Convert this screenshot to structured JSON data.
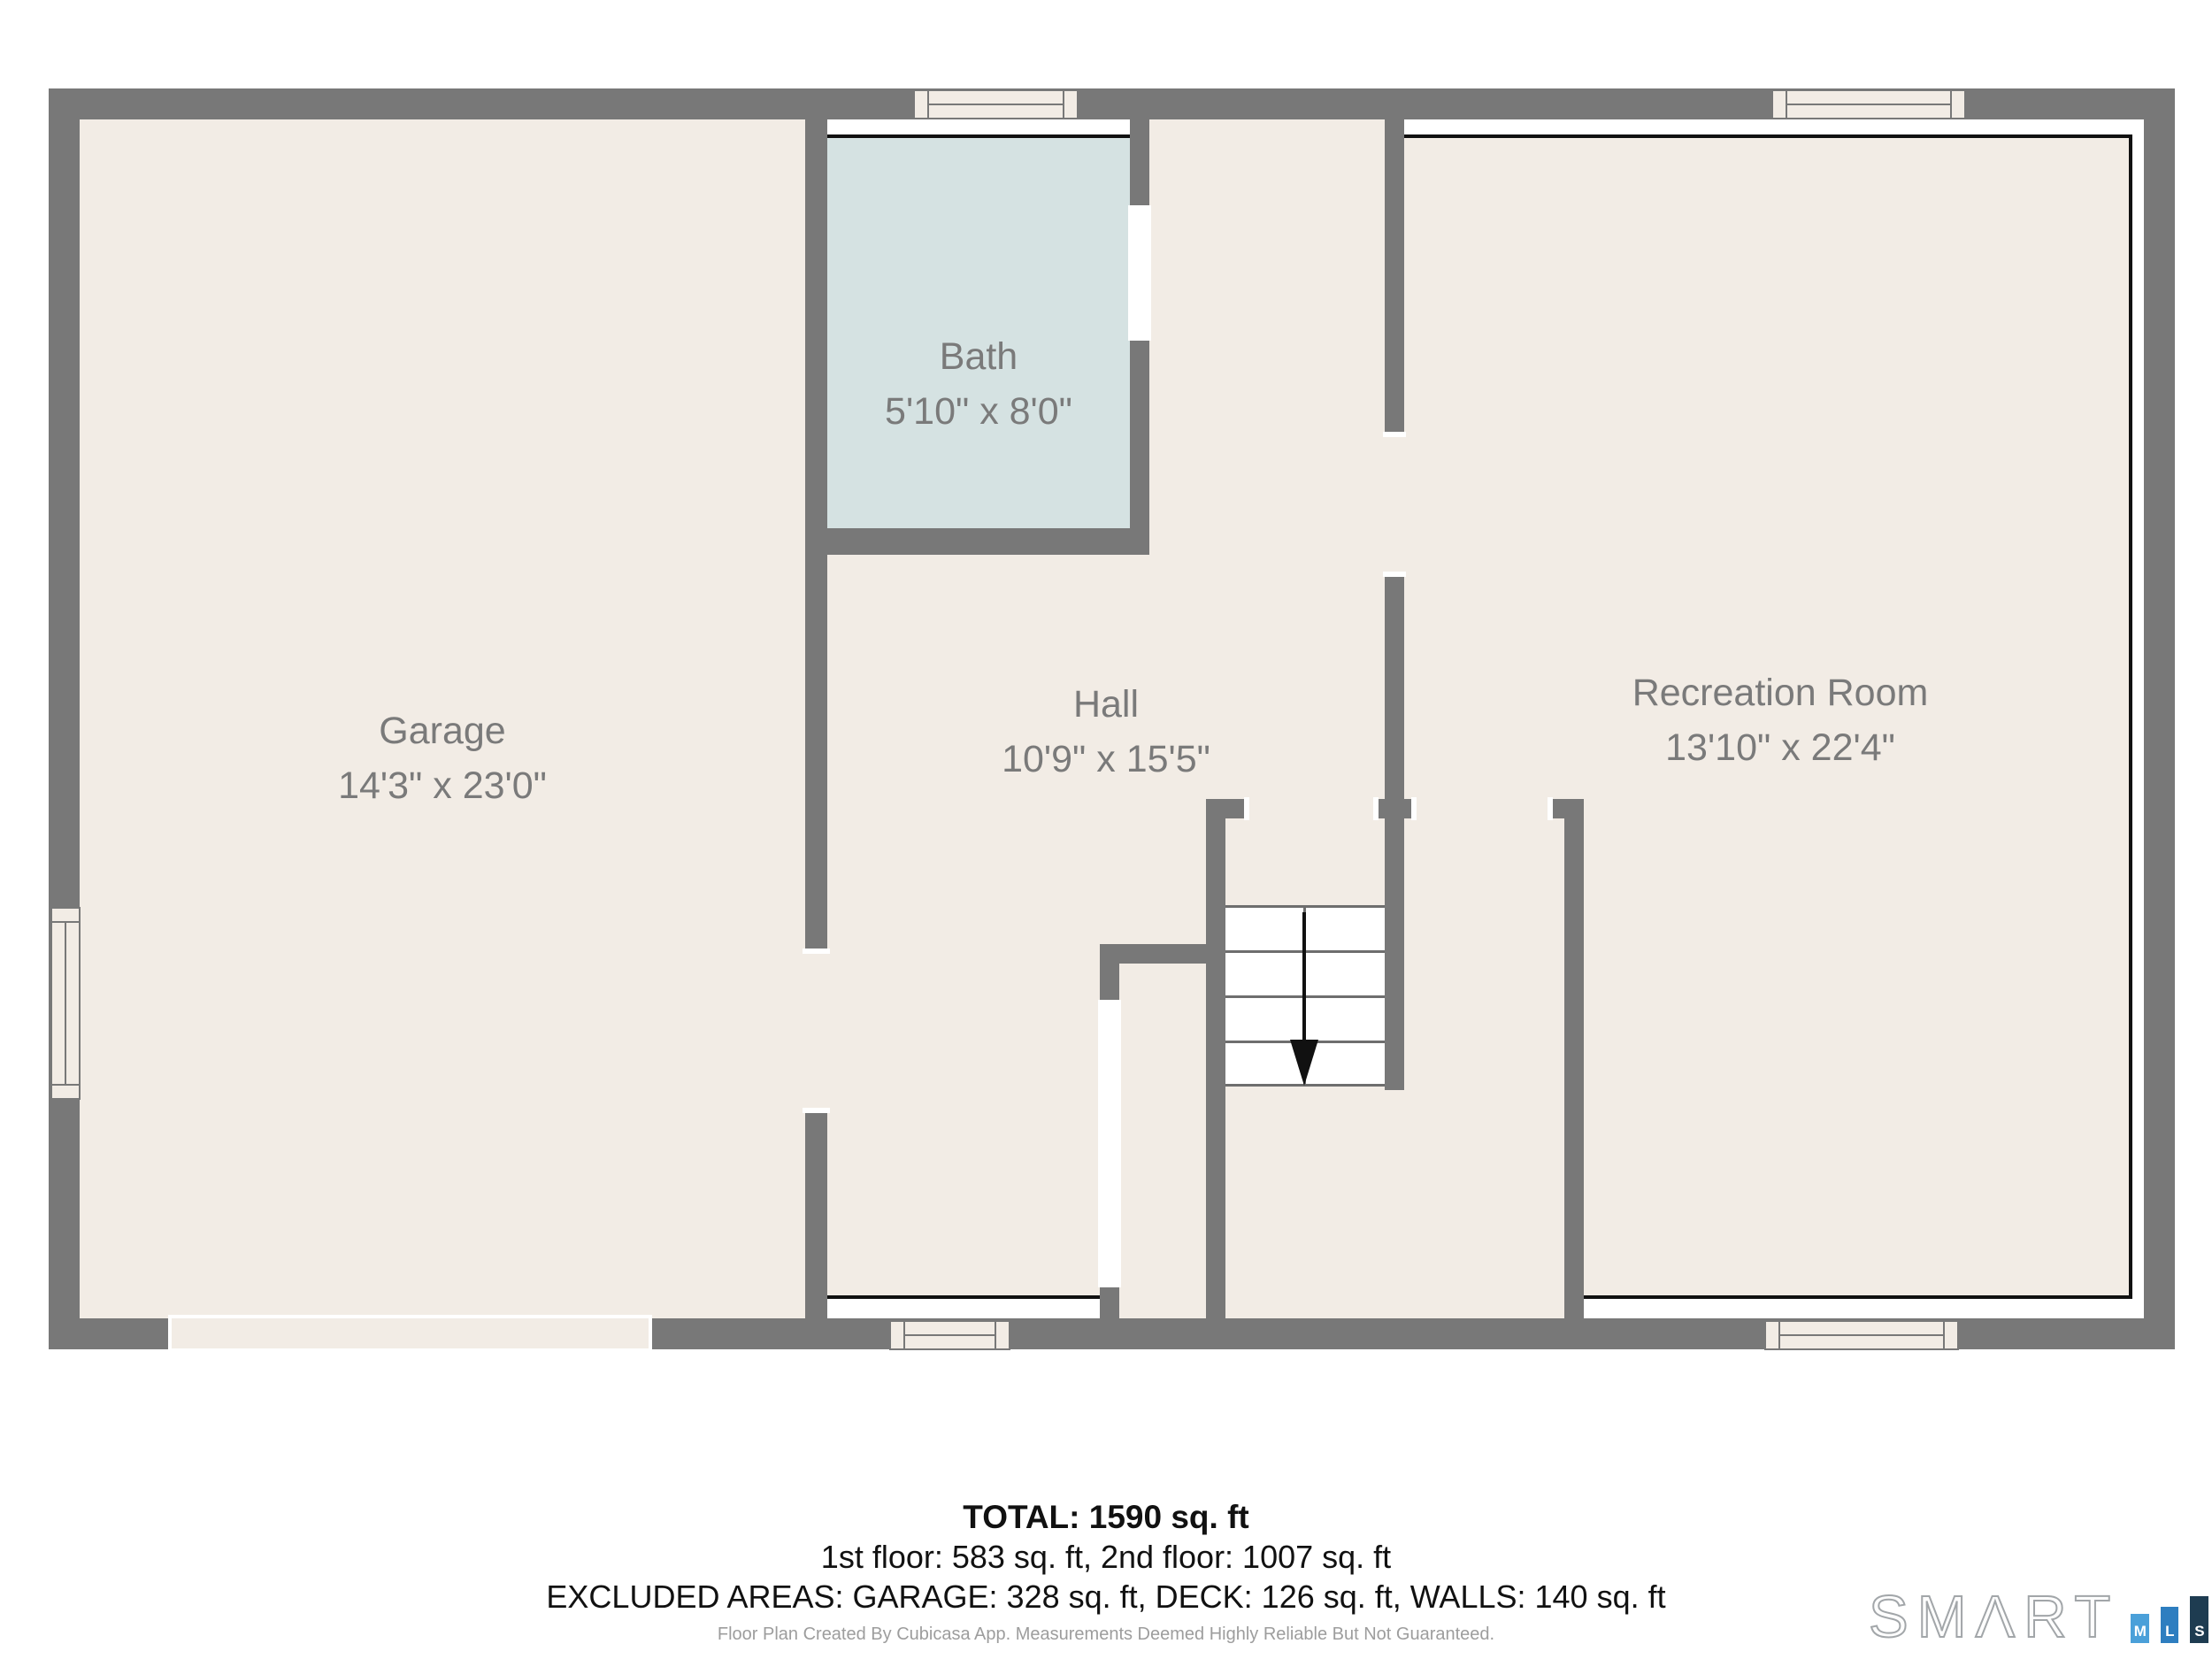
{
  "document": {
    "type": "floor-plan",
    "floor": "1st floor"
  },
  "rooms": [
    {
      "name": "Garage",
      "dims": "14'3\" x 23'0\""
    },
    {
      "name": "Bath",
      "dims": "5'10\" x 8'0\""
    },
    {
      "name": "Hall",
      "dims": "10'9\" x 15'5\""
    },
    {
      "name": "Recreation Room",
      "dims": "13'10\" x 22'4\""
    }
  ],
  "stairs": {
    "direction": "down",
    "visible_steps": 4
  },
  "summary": {
    "total": "TOTAL: 1590 sq. ft",
    "floors": "1st floor: 583 sq. ft, 2nd floor: 1007 sq. ft",
    "excluded": "EXCLUDED AREAS: GARAGE: 328 sq. ft, DECK: 126 sq. ft, WALLS: 140 sq. ft"
  },
  "disclaimer": "Floor Plan Created By Cubicasa App. Measurements Deemed Highly Reliable But Not Guaranteed.",
  "logo": {
    "brand": "SMΛRT",
    "squares": [
      {
        "letter": "M",
        "color": "#4ba0d9"
      },
      {
        "letter": "L",
        "color": "#2e7ec0"
      },
      {
        "letter": "S",
        "color": "#1e3c51"
      }
    ]
  },
  "colors": {
    "wall": "#787878",
    "floor": "#f2ece5",
    "bath_floor": "#d5e2e2",
    "room_label": "#7a7a7a",
    "outline": "#111111"
  }
}
